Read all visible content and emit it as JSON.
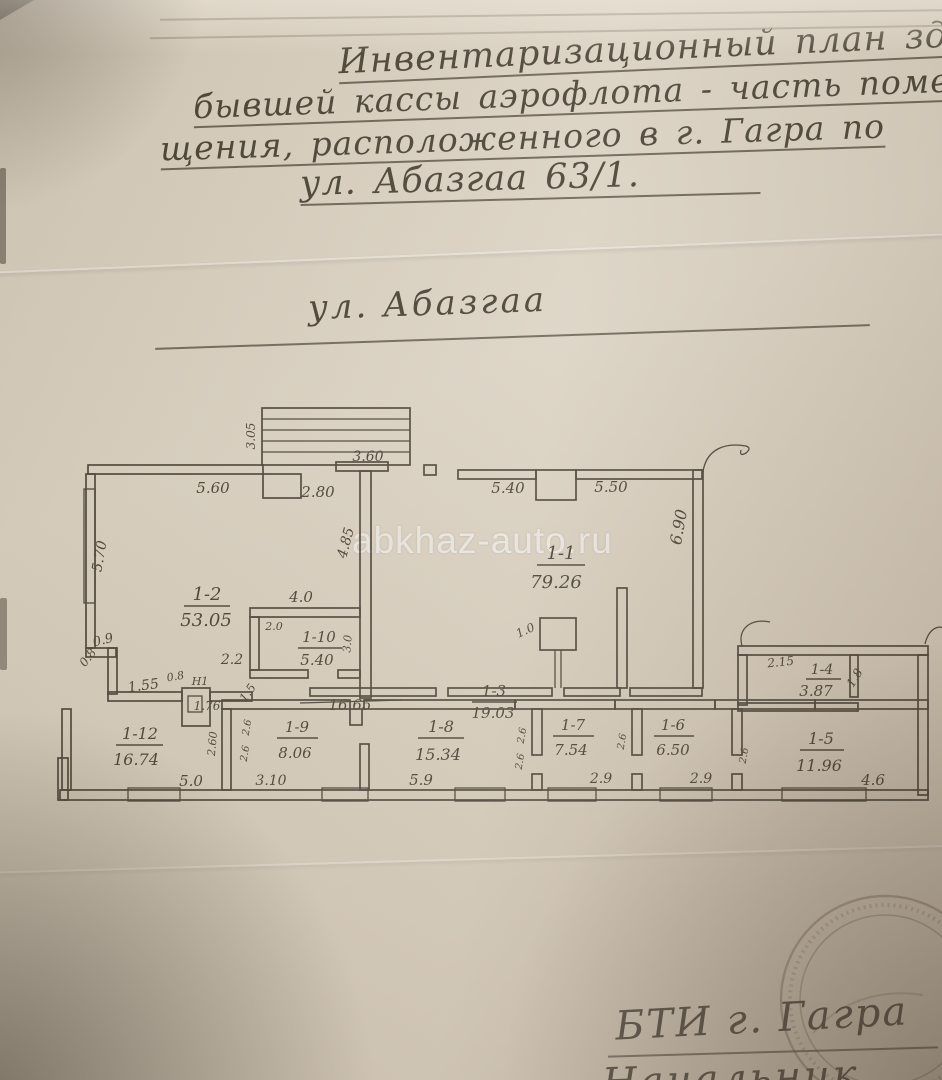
{
  "document": {
    "title_lines": [
      "Инвентаризационный план здан",
      "бывшей кассы  аэрофлота - часть поме",
      "щения, расположенного в г. Гагра по",
      "ул. Абазгаа   63/1."
    ],
    "street_label": "ул. Абазгаа",
    "watermark": "abkhaz-auto.ru",
    "footer_line1": "БТИ г. Гагра",
    "footer_line2_partial": "Начальник"
  },
  "plan": {
    "rooms": [
      {
        "id": "1-2",
        "area": "53.05"
      },
      {
        "id": "1-1",
        "area": "79.26"
      },
      {
        "id": "1-10",
        "area": "5.40"
      },
      {
        "id": "1-3",
        "area": "19.03"
      },
      {
        "id": "1-12",
        "area": "16.74"
      },
      {
        "id": "1-9",
        "area": "8.06"
      },
      {
        "id": "1-8",
        "area": "15.34"
      },
      {
        "id": "1-7",
        "area": "7.54"
      },
      {
        "id": "1-6",
        "area": "6.50"
      },
      {
        "id": "1-5",
        "area": "11.96"
      },
      {
        "id": "1-4",
        "area": "3.87"
      }
    ],
    "dims": {
      "stairs_depth": "3.05",
      "stairs_width": "3.60",
      "top_560": "5.60",
      "top_280": "2.80",
      "left_570": "5.70",
      "wall_485": "4.85",
      "wall_40": "4.0",
      "t11_540": "5.40",
      "t11_550": "5.50",
      "right_690": "6.90",
      "col_10": "1.0",
      "s_09": "0.9",
      "s_08a": "0.8",
      "s_155": "1.55",
      "s_08b": "0.8",
      "lift_label": "Н1",
      "lift_176": "1.76",
      "s_15": "1.5",
      "corr_1665": "16.65",
      "r10_20": "2.0",
      "r10_30": "3.0",
      "r10_22": "2.2",
      "r12_260": "2.60",
      "r12_50": "5.0",
      "r9_26a": "2.6",
      "r9_26b": "2.6",
      "r9_310": "3.10",
      "r8_59": "5.9",
      "r7_26a": "2.6",
      "r7_26b": "2.6",
      "r7_29": "2.9",
      "r6_26": "2.6",
      "r6_29": "2.9",
      "r5_26": "2.6",
      "r5_46": "4.6",
      "r4_215": "2.15",
      "r4_18": "1.8"
    }
  }
}
